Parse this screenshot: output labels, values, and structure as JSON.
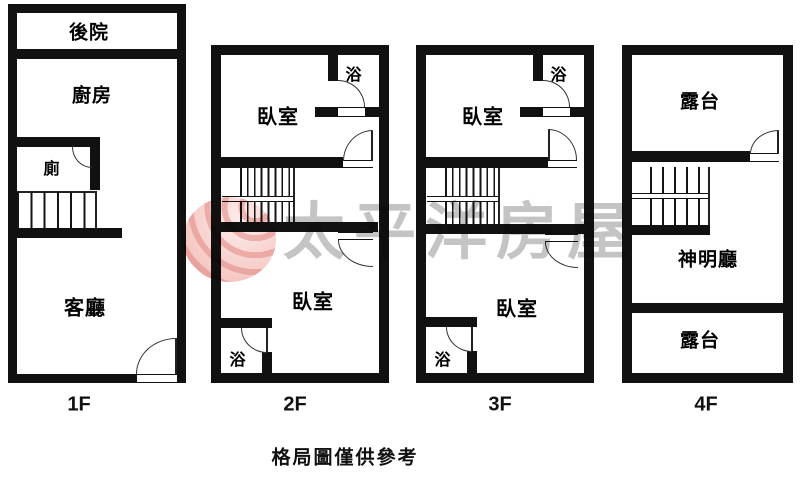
{
  "plans": [
    {
      "floor": "1F",
      "rooms": {
        "backyard": "後院",
        "kitchen": "廚房",
        "toilet": "廁",
        "living": "客廳"
      }
    },
    {
      "floor": "2F",
      "rooms": {
        "bedroom_upper": "臥室",
        "bath_upper": "浴",
        "bedroom_lower": "臥室",
        "bath_lower": "浴"
      }
    },
    {
      "floor": "3F",
      "rooms": {
        "bedroom_upper": "臥室",
        "bath_upper": "浴",
        "bedroom_lower": "臥室",
        "bath_lower": "浴"
      }
    },
    {
      "floor": "4F",
      "rooms": {
        "terrace_upper": "露台",
        "shrine": "神明廳",
        "terrace_lower": "露台"
      }
    }
  ],
  "watermark": {
    "brand": "太平洋房屋"
  },
  "caption": "格局圖僅供參考",
  "colors": {
    "wall": "#111111",
    "watermark_text": "#8a8a8a",
    "logo_red": "#ef9e98"
  }
}
